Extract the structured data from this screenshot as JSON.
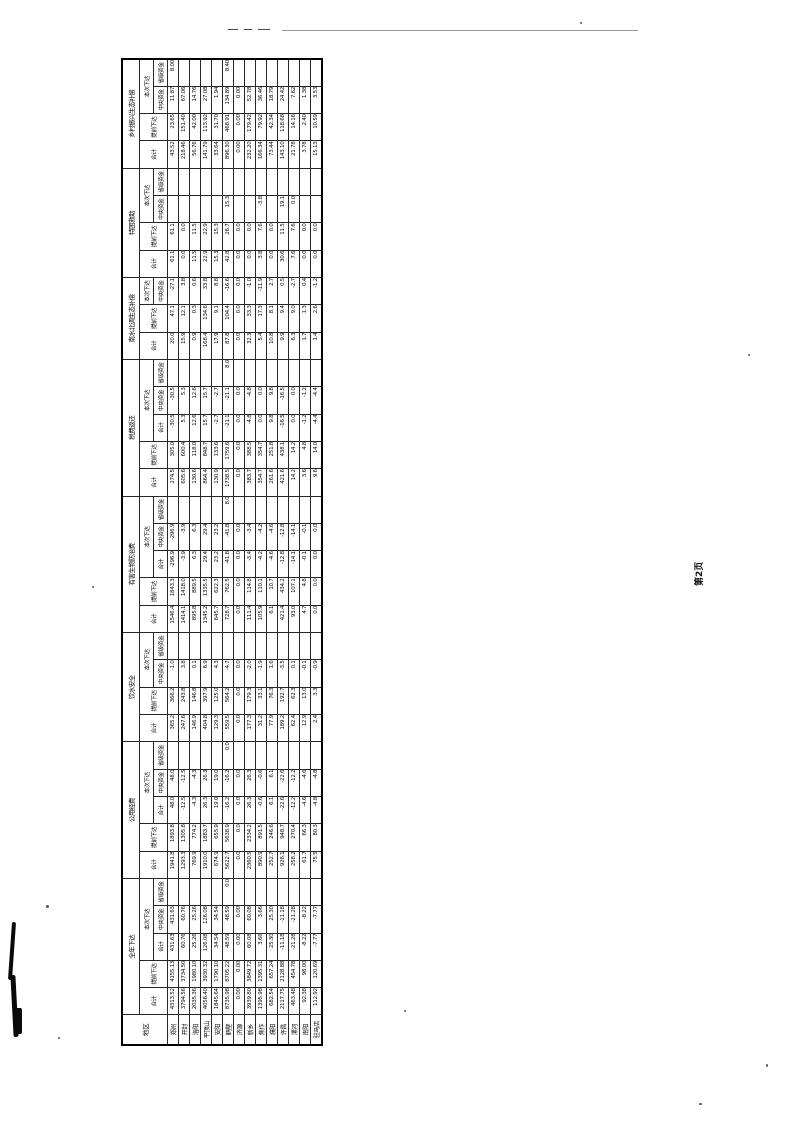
{
  "page": {
    "label": "第2页"
  },
  "table": {
    "corner_label": "地区",
    "header_labels": {
      "total": "合计",
      "advance": "提前下达",
      "current": "本次下达",
      "current_total": "合计",
      "central": "中央资金",
      "provincial": "省级资金"
    },
    "groups": [
      {
        "label": "全年下达",
        "cols": [
          "total",
          "advance",
          "current_total",
          "central",
          "provincial"
        ]
      },
      {
        "label": "公用经费",
        "cols": [
          "total",
          "advance",
          "current_total",
          "central",
          "provincial"
        ]
      },
      {
        "label": "饮水安全",
        "cols": [
          "total",
          "advance",
          "central",
          "provincial"
        ]
      },
      {
        "label": "有害生物防治费",
        "cols": [
          "total",
          "advance",
          "current_total",
          "central",
          "provincial"
        ]
      },
      {
        "label": "税费返还",
        "cols": [
          "total",
          "advance",
          "current_total",
          "central",
          "provincial"
        ]
      },
      {
        "label": "南水北调生态补偿",
        "cols": [
          "total",
          "advance",
          "central"
        ]
      },
      {
        "label": "特困救助",
        "cols": [
          "total",
          "advance",
          "central",
          "provincial"
        ]
      },
      {
        "label": "乡村振兴生态补偿",
        "cols": [
          "total",
          "advance",
          "central",
          "provincial"
        ]
      }
    ],
    "regions": [
      "郑州",
      "开封",
      "洛阳",
      "平顶山",
      "安阳",
      "鹤壁",
      "济源",
      "新乡",
      "焦作",
      "濮阳",
      "许昌",
      "漯河",
      "南阳",
      "驻马店"
    ],
    "values": [
      [
        [
          "4313.52",
          "4155.13",
          "431.63",
          "431.63",
          ""
        ],
        [
          "1941.8",
          "1893.8",
          "48.0",
          "48.0",
          ""
        ],
        [
          "365.2",
          "366.2",
          "-1.0",
          ""
        ],
        [
          "1546.4",
          "1843.3",
          "-296.9",
          "-296.9",
          ""
        ],
        [
          "274.5",
          "305.0",
          "-30.5",
          "-30.5",
          ""
        ],
        [
          "20.0",
          "47.1",
          "-27.1"
        ],
        [
          "61.1",
          "61.1",
          "",
          ""
        ],
        [
          "43.52",
          "23.65",
          "11.87",
          "8.00"
        ]
      ],
      [
        [
          "3794.56",
          "3734.50",
          "60.76",
          "60.76",
          ""
        ],
        [
          "1293.3",
          "1305.8",
          "-12.5",
          "-12.5",
          ""
        ],
        [
          "247.6",
          "243.8",
          "3.8",
          ""
        ],
        [
          "1414.1",
          "1418.0",
          "-3.9",
          "-3.9",
          ""
        ],
        [
          "605.6",
          "600.4",
          "5.3",
          "5.3",
          ""
        ],
        [
          "15.9",
          "12.1",
          "3.8"
        ],
        [
          "0.0",
          "0.0",
          "",
          ""
        ],
        [
          "218.46",
          "151.40",
          "67.06",
          ""
        ]
      ],
      [
        [
          "2035.36",
          "1980.10",
          "25.26",
          "25.26",
          ""
        ],
        [
          "769.9",
          "774.2",
          "-4.3",
          "-4.3",
          ""
        ],
        [
          "146.9",
          "146.8",
          "0.1",
          ""
        ],
        [
          "895.8",
          "889.5",
          "6.3",
          "6.3",
          ""
        ],
        [
          "130.6",
          "118.0",
          "12.6",
          "12.6",
          ""
        ],
        [
          "0.9",
          "0.3",
          "0.6"
        ],
        [
          "11.5",
          "11.5",
          "",
          ""
        ],
        [
          "56.76",
          "42.00",
          "14.76",
          ""
        ]
      ],
      [
        [
          "4056.40",
          "3930.32",
          "126.08",
          "126.08",
          ""
        ],
        [
          "1910.0",
          "1883.7",
          "26.3",
          "26.3",
          ""
        ],
        [
          "404.8",
          "397.9",
          "6.9",
          ""
        ],
        [
          "1345.2",
          "1335.5",
          "29.4",
          "29.4",
          ""
        ],
        [
          "864.4",
          "848.7",
          "15.7",
          "15.7",
          ""
        ],
        [
          "168.4",
          "134.6",
          "33.8"
        ],
        [
          "22.9",
          "22.9",
          "",
          ""
        ],
        [
          "141.79",
          "113.92",
          "27.08",
          ""
        ]
      ],
      [
        [
          "1845.64",
          "1790.10",
          "34.54",
          "34.54",
          ""
        ],
        [
          "674.9",
          "655.9",
          "19.0",
          "19.0",
          ""
        ],
        [
          "129.3",
          "125.0",
          "4.3",
          ""
        ],
        [
          "645.7",
          "622.3",
          "23.2",
          "23.2",
          ""
        ],
        [
          "130.9",
          "133.6",
          "-2.7",
          "-2.7",
          ""
        ],
        [
          "17.9",
          "9.1",
          "8.8"
        ],
        [
          "15.3",
          "15.3",
          "",
          ""
        ],
        [
          "33.64",
          "31.70",
          "1.94",
          ""
        ]
      ],
      [
        [
          "8735.98",
          "8705.22",
          "48.59",
          "48.59",
          "0.0"
        ],
        [
          "5622.7",
          "5638.9",
          "-16.2",
          "-16.2",
          "0.0"
        ],
        [
          "559.5",
          "564.2",
          "-4.7",
          ""
        ],
        [
          "728.7",
          "762.5",
          "-41.8",
          "-41.8",
          "8.0"
        ],
        [
          "1738.5",
          "1759.6",
          "-21.1",
          "-21.1",
          "8.0"
        ],
        [
          "87.8",
          "104.4",
          "-16.6"
        ],
        [
          "42.8",
          "26.7",
          "15.3",
          ""
        ],
        [
          "896.30",
          "468.91",
          "134.89",
          "8.40"
        ]
      ],
      [
        [
          "0.00",
          "0.00",
          "0.00",
          "0.00",
          ""
        ],
        [
          "0.0",
          "0.0",
          "0.0",
          "0.0",
          ""
        ],
        [
          "0.0",
          "0.0",
          "0.0",
          ""
        ],
        [
          "0.0",
          "0.0",
          "0.0",
          "0.0",
          ""
        ],
        [
          "0.0",
          "0.0",
          "0.0",
          "0.0",
          ""
        ],
        [
          "0.0",
          "0.0",
          "0.0"
        ],
        [
          "0.0",
          "0.0",
          "",
          ""
        ],
        [
          "0.00",
          "0.00",
          "0.00",
          ""
        ]
      ],
      [
        [
          "3939.80",
          "3849.72",
          "60.08",
          "60.08",
          ""
        ],
        [
          "2360.5",
          "2334.2",
          "26.3",
          "26.3",
          ""
        ],
        [
          "177.3",
          "179.3",
          "-2.0",
          ""
        ],
        [
          "111.4",
          "114.8",
          "-3.4",
          "-3.4",
          ""
        ],
        [
          "383.7",
          "388.5",
          "-4.8",
          "-4.8",
          ""
        ],
        [
          "32.3",
          "33.3",
          "-1.0"
        ],
        [
          "0.0",
          "0.0",
          "",
          ""
        ],
        [
          "232.20",
          "179.42",
          "52.78",
          ""
        ]
      ],
      [
        [
          "1395.98",
          "1395.31",
          "3.66",
          "3.66",
          ""
        ],
        [
          "890.9",
          "891.5",
          "-0.6",
          "-0.6",
          ""
        ],
        [
          "31.2",
          "33.1",
          "-1.9",
          ""
        ],
        [
          "105.9",
          "110.1",
          "-4.2",
          "-4.2",
          ""
        ],
        [
          "354.7",
          "354.7",
          "0.0",
          "0.0",
          ""
        ],
        [
          "5.4",
          "17.3",
          "-11.9"
        ],
        [
          "3.8",
          "7.6",
          "-3.8",
          ""
        ],
        [
          "166.34",
          "79.92",
          "36.46",
          ""
        ]
      ],
      [
        [
          "682.54",
          "657.24",
          "25.30",
          "25.30",
          ""
        ],
        [
          "252.7",
          "246.6",
          "6.1",
          "6.1",
          ""
        ],
        [
          "77.9",
          "76.3",
          "1.6",
          ""
        ],
        [
          "6.1",
          "10.7",
          "-4.6",
          "-4.6",
          ""
        ],
        [
          "261.6",
          "251.8",
          "9.8",
          "9.8",
          ""
        ],
        [
          "10.8",
          "8.1",
          "2.7"
        ],
        [
          "0.0",
          "0.0",
          "",
          ""
        ],
        [
          "73.44",
          "42.34",
          "18.79",
          ""
        ]
      ],
      [
        [
          "2117.75",
          "2128.88",
          "-11.18",
          "-11.18",
          ""
        ],
        [
          "926.1",
          "948.7",
          "-22.6",
          "-22.6",
          ""
        ],
        [
          "189.2",
          "192.7",
          "-3.5",
          ""
        ],
        [
          "421.4",
          "434.2",
          "-12.8",
          "-12.8",
          ""
        ],
        [
          "421.6",
          "438.1",
          "-16.5",
          "-16.5",
          ""
        ],
        [
          "9.9",
          "9.4",
          "0.5"
        ],
        [
          "30.6",
          "11.5",
          "19.1",
          ""
        ],
        [
          "143.10",
          "118.68",
          "24.42",
          ""
        ]
      ],
      [
        [
          "463.48",
          "454.78",
          "-21.28",
          "-21.28",
          ""
        ],
        [
          "258.2",
          "270.4",
          "-12.2",
          "-12.2",
          ""
        ],
        [
          "62.4",
          "62.3",
          "0.1",
          ""
        ],
        [
          "93.0",
          "107.1",
          "-14.1",
          "-14.1",
          ""
        ],
        [
          "14.2",
          "14.2",
          "0.0",
          "0.0",
          ""
        ],
        [
          "6.3",
          "9.0",
          "-2.7"
        ],
        [
          "7.6",
          "7.6",
          "0.0",
          ""
        ],
        [
          "21.78",
          "14.16",
          "7.62",
          ""
        ]
      ],
      [
        [
          "92.38",
          "98.00",
          "-8.22",
          "-8.22",
          ""
        ],
        [
          "61.7",
          "66.3",
          "-4.6",
          "-4.6",
          ""
        ],
        [
          "12.9",
          "13.0",
          "-0.1",
          ""
        ],
        [
          "4.7",
          "4.8",
          "-0.1",
          "-0.1",
          ""
        ],
        [
          "3.6",
          "4.8",
          "-1.2",
          "-1.2",
          ""
        ],
        [
          "1.7",
          "1.3",
          "0.4"
        ],
        [
          "0.0",
          "0.0",
          "",
          ""
        ],
        [
          "3.78",
          "2.40",
          "1.38",
          ""
        ]
      ],
      [
        [
          "112.92",
          "120.69",
          "-7.77",
          "-7.77",
          ""
        ],
        [
          "75.5",
          "80.3",
          "-4.8",
          "-4.8",
          ""
        ],
        [
          "2.4",
          "3.3",
          "-0.9",
          ""
        ],
        [
          "0.0",
          "0.0",
          "0.0",
          "0.0",
          ""
        ],
        [
          "9.6",
          "14.0",
          "-4.4",
          "-4.4",
          ""
        ],
        [
          "1.4",
          "2.6",
          "-1.2"
        ],
        [
          "0.0",
          "0.0",
          "",
          ""
        ],
        [
          "15.13",
          "10.59",
          "3.53",
          ""
        ]
      ]
    ]
  }
}
